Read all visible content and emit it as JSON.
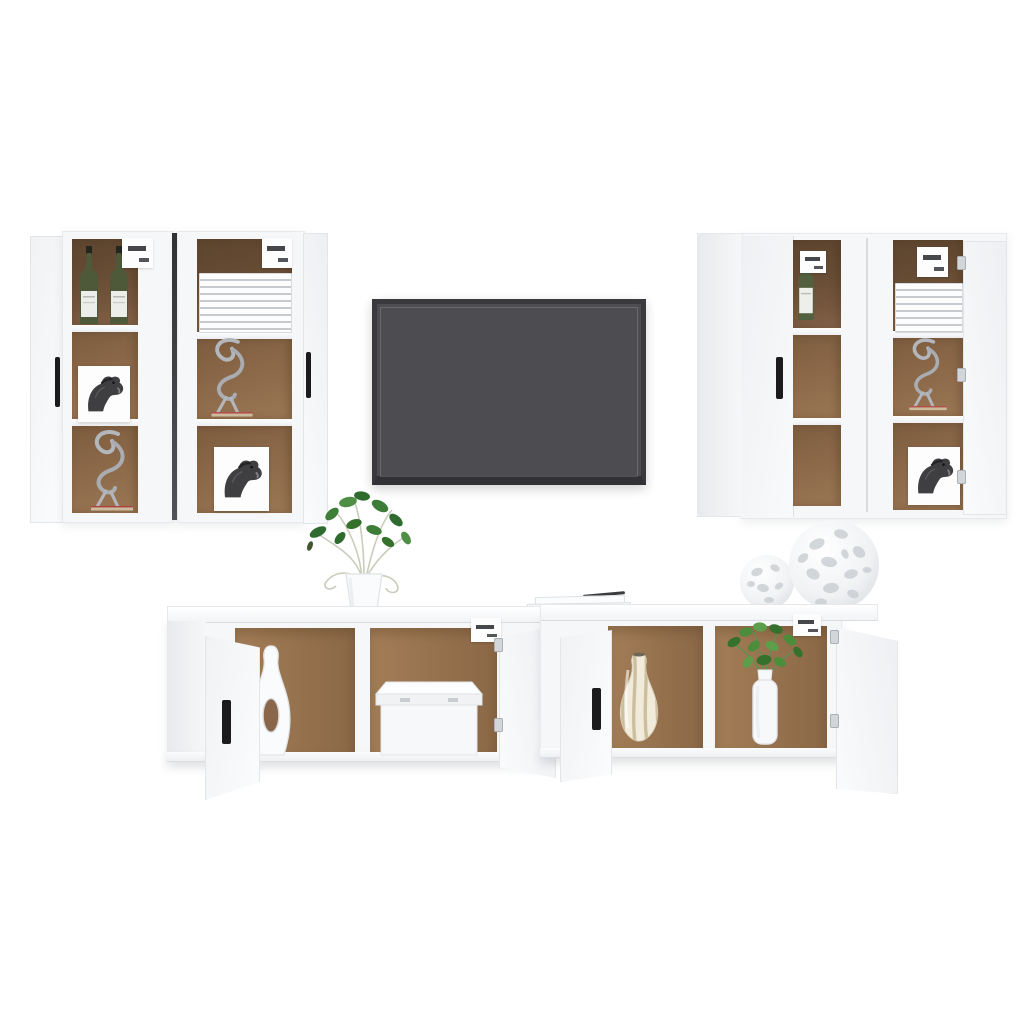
{
  "meta": {
    "type": "product-photo",
    "subject": "7-piece white wall-mounted TV cabinet furniture set with flat-screen TV and decor on a white background"
  },
  "colors": {
    "background": "#ffffff",
    "cabinet_white": "#f6f7f8",
    "cabinet_shade": "#e8eaed",
    "interior_brown": "#8f6b4a",
    "interior_brown_dark": "#654a31",
    "shelf_white": "#f2f4f5",
    "handle_black": "#1b1b1d",
    "tv_frame": "#3a3a3e",
    "tv_screen": "#4c4c51",
    "bottle_green": "#4d5939",
    "plant_green": "#3e7d38",
    "metal_silver": "#b3b7bb",
    "stripe_beige": "#cdbf9e",
    "sculpture_base_tan": "#cbbb9d"
  },
  "items": {
    "left_wall_unit": "Left pair of tall wall cabinets with open doors",
    "right_wall_unit": "Right pair of tall wall cabinets, one door closed and one open",
    "tv": "Wall-mounted dark grey flat-screen TV",
    "bottom_left_cabinet": "Low floating TV cabinet with two open doors, vase and storage box inside",
    "bottom_right_cabinet": "Low floating TV cabinet with two open doors, striped vase and potted plant inside",
    "wine_bottles": "Two green bottles with white labels",
    "champagne_bottle": "Single green bottle with white label",
    "magazines": "Stack of white magazines",
    "horse_picture": "White card with sketched horse head",
    "wire_sculpture": "Silver wire animal sculpture on tan base",
    "white_vase": "White sculptural vase with oval cut-out",
    "storage_box": "White storage box with lid",
    "striped_vase": "Cream vase with beige swirl stripes",
    "potted_plant_small": "Green plant in white bottle vase",
    "potted_plant_top": "Leafy green plant in white jug on cabinet top",
    "decor_spheres": "Two white openwork decorative spheres",
    "books": "Two stacked white books with a dark pen"
  }
}
